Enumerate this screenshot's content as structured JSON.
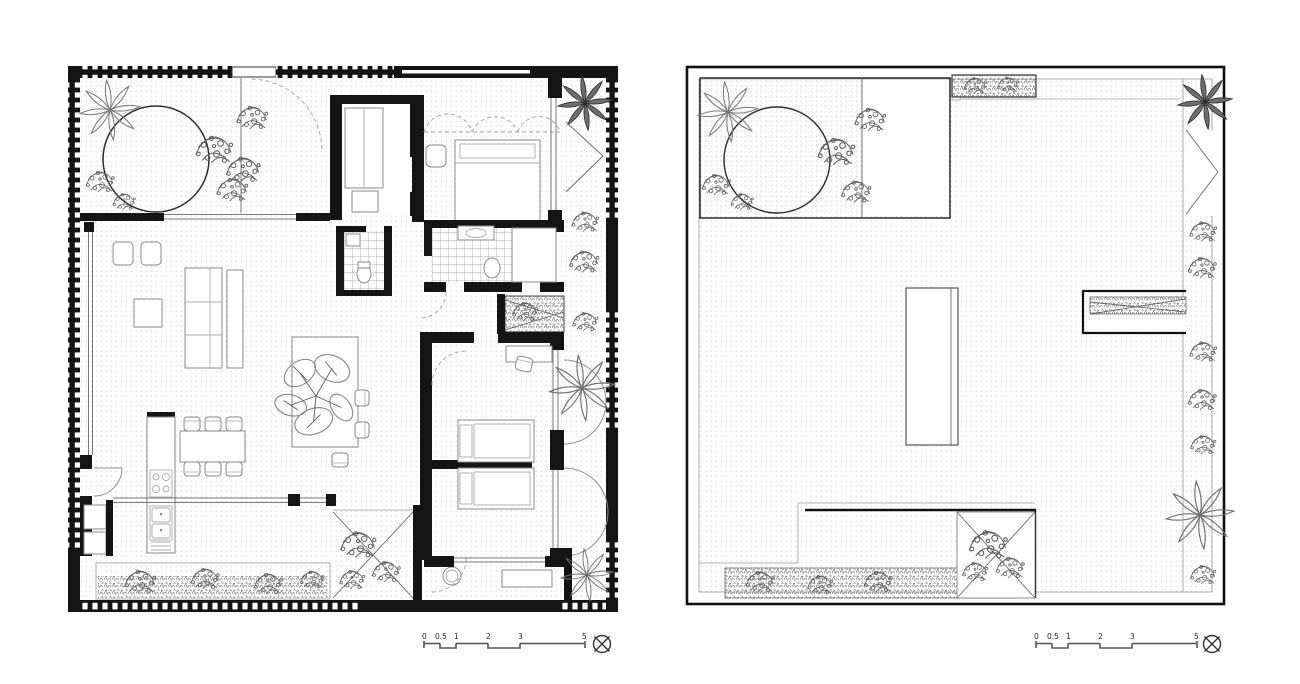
{
  "palette": {
    "paper": "#ffffff",
    "ink": "#141414",
    "line_gray": "#8a8a8a",
    "ground_dot": "#c4c4c4"
  },
  "icons": {
    "north": "circle-with-diagonal-cross",
    "tree_canopy": "outline-circle",
    "palm": "radial-leaf-star",
    "shrub": "bubble-scribble-cluster"
  },
  "scale_bar_left": {
    "unit_marks": [
      "0",
      "0.5",
      "1",
      "2",
      "3",
      "5"
    ]
  },
  "scale_bar_right": {
    "unit_marks": [
      "0",
      "0.5",
      "1",
      "2",
      "3",
      "5"
    ]
  }
}
